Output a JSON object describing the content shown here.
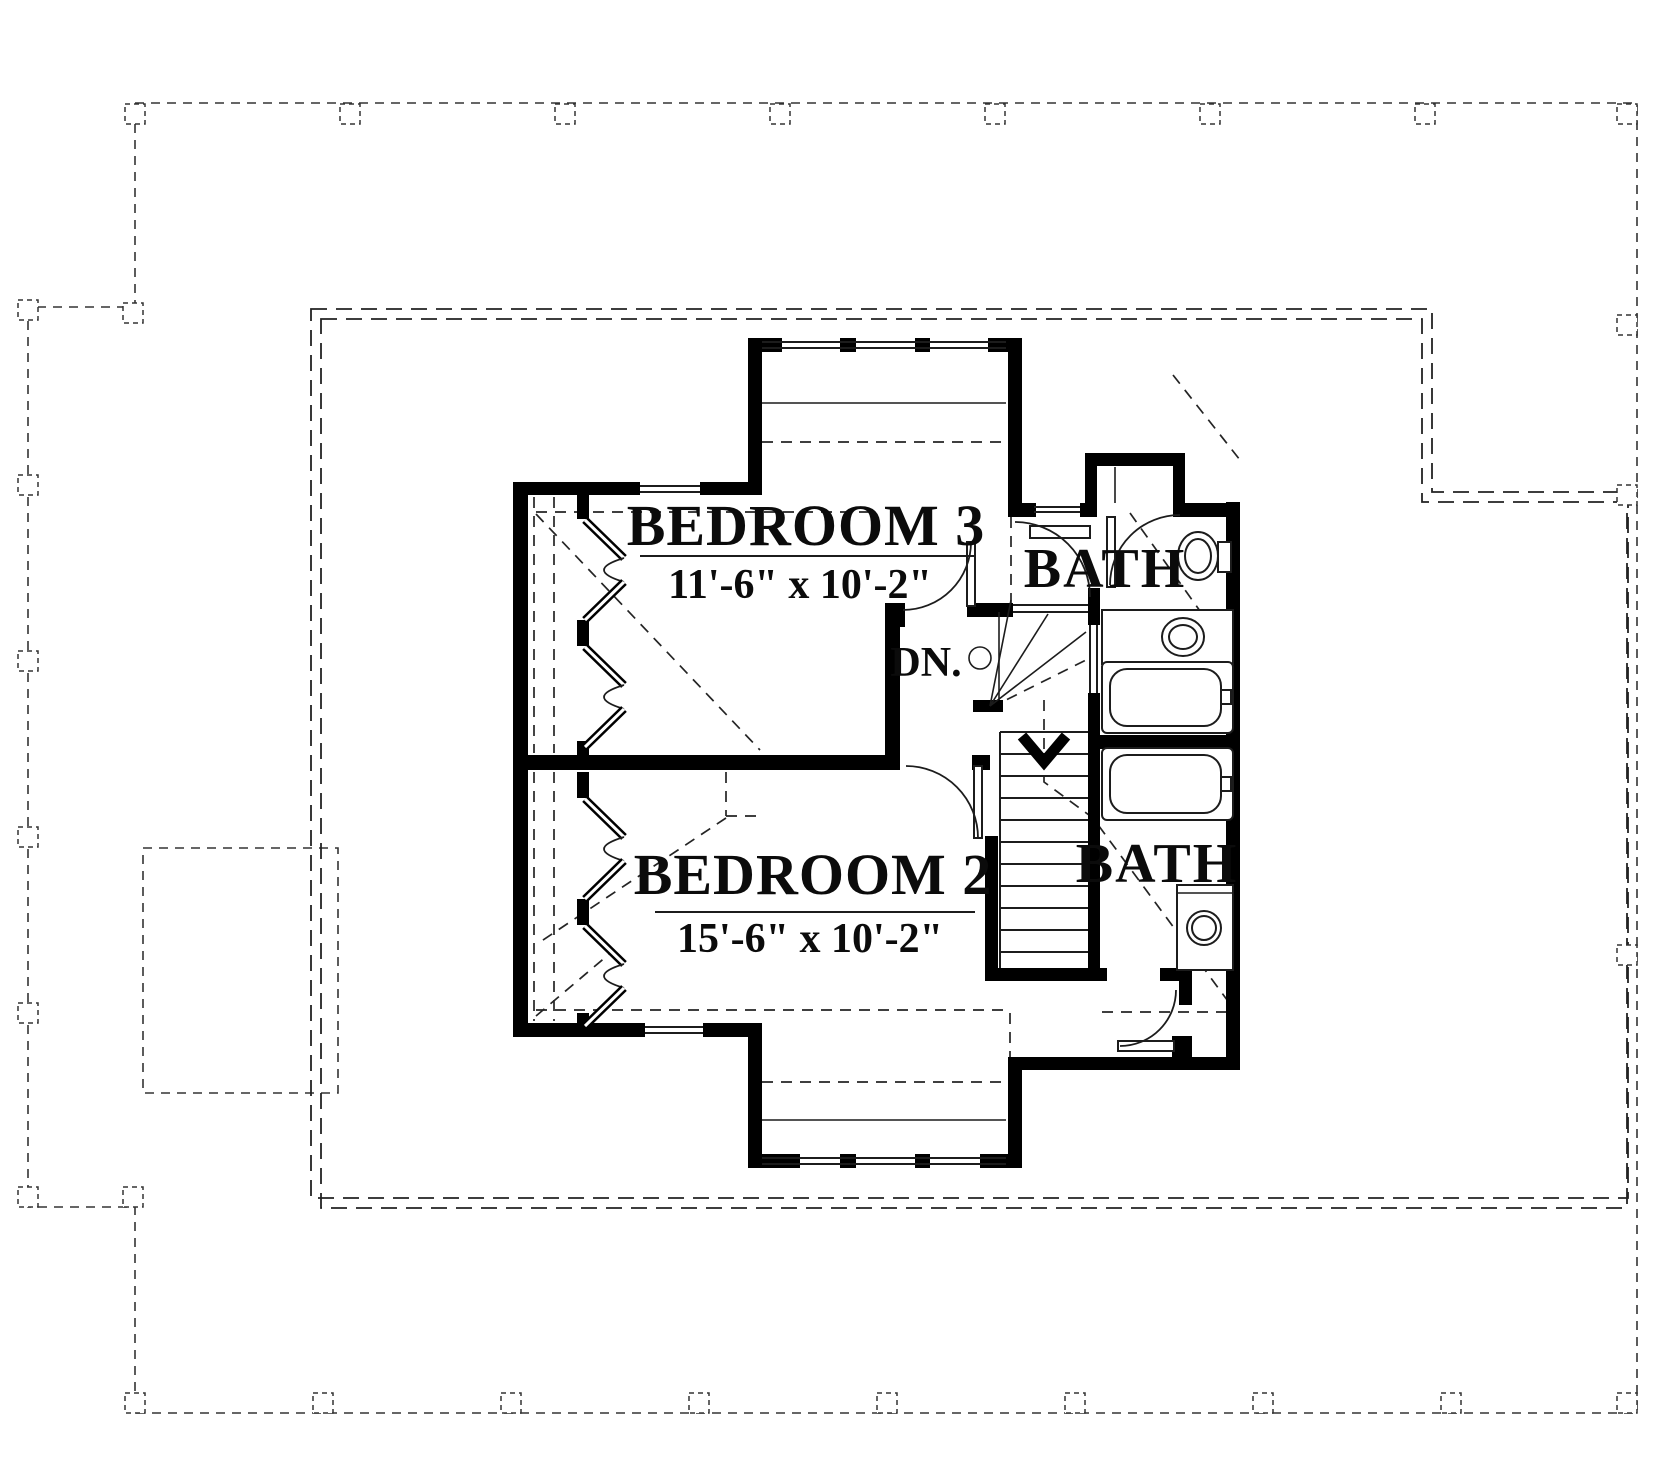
{
  "plan": {
    "bedroom3": {
      "name": "BEDROOM 3",
      "dims": "11'-6\" x 10'-2\""
    },
    "bedroom2": {
      "name": "BEDROOM 2",
      "dims": "15'-6\" x 10'-2\""
    },
    "bath_top": {
      "name": "BATH"
    },
    "bath_bottom": {
      "name": "BATH"
    },
    "stair": {
      "down": "DN."
    },
    "colors": {
      "walls": "#000000",
      "lines": "#1c1c1c",
      "background": "#ffffff"
    }
  }
}
